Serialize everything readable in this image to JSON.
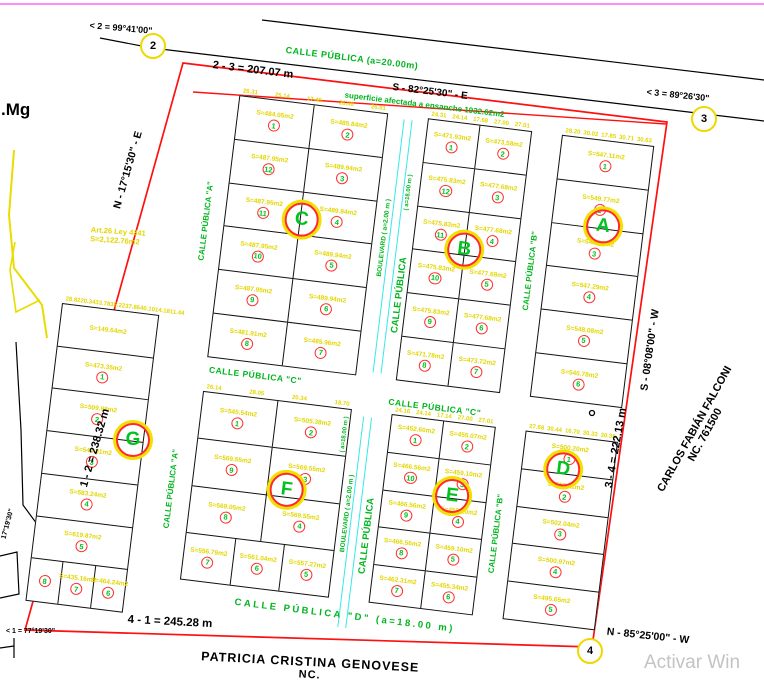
{
  "watermark": "Activar Win",
  "labels": {
    "mg": ".Mg",
    "ensanche": "superficie afectada a ensanche 1932.62m2",
    "art_law_1": "Art.26 Ley 4341",
    "art_law_2": "S=2,122.76m2",
    "left_angle_small": "17°19'30\"",
    "corner1_angle": "< 1 = 77°19'30\"",
    "corner2_angle": "< 2 = 99°41'00\"",
    "corner3_angle": "< 3 = 89°26'30\""
  },
  "boundary": {
    "top_length": "2 - 3 = 207.07 m",
    "top_bearing": "S - 82°25'30\" - E",
    "right_length": "3 - 4 = 222.13 m",
    "right_bearing": "S - 08°08'00\" - W",
    "bottom_length": "4 - 1 = 245.28 m",
    "bottom_bearing": "N - 85°25'00\" - W",
    "left_length": "1 - 2 = 238.32 m",
    "left_bearing": "N - 17°15'30\" - E",
    "corners": {
      "c1": "1",
      "c2": "2",
      "c3": "3",
      "c4": "4"
    }
  },
  "neighbors": {
    "right_name": "CARLOS FABIÁN FALCONI",
    "right_nc": "NC. 761500",
    "bottom_name": "PATRICIA CRISTINA GENOVESE",
    "bottom_nc": "NC."
  },
  "streets": {
    "top": "CALLE PÚBLICA (a=20.00m)",
    "a_upper": "CALLE PÚBLICA \"A\"",
    "a_lower": "CALLE PÚBLICA \"A\"",
    "b_upper": "CALLE PÚBLICA \"B\"",
    "b_lower": "CALLE PÚBLICA \"B\"",
    "c_left": "CALLE PÚBLICA \"C\"",
    "c_right": "CALLE PÚBLICA \"C\"",
    "d": "CALLE PÚBLICA \"D\" (a=18.00 m)",
    "central_upper": "CALLE PÚBLICA",
    "central_lower": "CALLE PÚBLICA",
    "central_width_upper": "( a=18.00 m )",
    "central_width_lower": "( a=18.00 m )",
    "boulevard_upper": "BOULEVARD ( a=2.00 m )",
    "boulevard_lower": "BOULEVARD ( a=2.00 m )"
  },
  "blocks": {
    "C": {
      "letter": "C",
      "dims": [
        "26.31",
        "25.14",
        "17.48",
        "26.00",
        "26.01"
      ],
      "lots": [
        {
          "n": "1",
          "area": "S=484.05m2"
        },
        {
          "n": "2",
          "area": "S=485.84m2"
        },
        {
          "n": "12",
          "area": "S=487.95m2"
        },
        {
          "n": "3",
          "area": "S=489.94m2"
        },
        {
          "n": "11",
          "area": "S=487.95m2"
        },
        {
          "n": "4",
          "area": "S=489.94m2"
        },
        {
          "n": "10",
          "area": "S=487.95m2"
        },
        {
          "n": "5",
          "area": "S=489.94m2"
        },
        {
          "n": "9",
          "area": "S=487.95m2"
        },
        {
          "n": "6",
          "area": "S=489.94m2"
        },
        {
          "n": "8",
          "area": "S=481.91m2"
        },
        {
          "n": "7",
          "area": "S=485.96m2"
        }
      ]
    },
    "B": {
      "letter": "B",
      "dims": [
        "24.31",
        "24.14",
        "17.68",
        "27.00",
        "27.01"
      ],
      "lots": [
        {
          "n": "1",
          "area": "S=471.93m2"
        },
        {
          "n": "2",
          "area": "S=473.58m2"
        },
        {
          "n": "12",
          "area": "S=475.83m2"
        },
        {
          "n": "3",
          "area": "S=477.68m2"
        },
        {
          "n": "11",
          "area": "S=475.83m2"
        },
        {
          "n": "4",
          "area": "S=477.68m2"
        },
        {
          "n": "10",
          "area": "S=475.83m2"
        },
        {
          "n": "5",
          "area": "S=477.68m2"
        },
        {
          "n": "9",
          "area": "S=475.83m2"
        },
        {
          "n": "6",
          "area": "S=477.68m2"
        },
        {
          "n": "8",
          "area": "S=471.78m2"
        },
        {
          "n": "7",
          "area": "S=473.72m2"
        }
      ]
    },
    "A": {
      "letter": "A",
      "dims": [
        "28.20",
        "30.02",
        "17.85",
        "30.71",
        "30.63"
      ],
      "lots": [
        {
          "n": "1",
          "area": "S=547.11m2"
        },
        {
          "n": "2",
          "area": "S=549.77m2"
        },
        {
          "n": "3",
          "area": "S=548.53m2"
        },
        {
          "n": "4",
          "area": "S=547.29m2"
        },
        {
          "n": "5",
          "area": "S=548.08m2"
        },
        {
          "n": "6",
          "area": "S=540.78m2"
        }
      ]
    },
    "F": {
      "letter": "F",
      "dims": [
        "26.14",
        "28.05",
        "20.34",
        "18.70"
      ],
      "lots": [
        {
          "n": "1",
          "area": "S=545.54m2"
        },
        {
          "n": "2",
          "area": "S=505.38m2"
        },
        {
          "n": "9",
          "area": "S=569.55m2"
        },
        {
          "n": "3",
          "area": "S=569.55m2"
        },
        {
          "n": "8",
          "area": "S=569.05m2"
        },
        {
          "n": "4",
          "area": "S=569.55m2"
        },
        {
          "n": "7",
          "area": "S=556.79m2"
        },
        {
          "n": "6",
          "area": "S=561.04m2"
        },
        {
          "n": "5",
          "area": "S=557.27m2"
        }
      ]
    },
    "E": {
      "letter": "E",
      "dims": [
        "24.16",
        "24.14",
        "17.14",
        "27.00",
        "27.01"
      ],
      "lots": [
        {
          "n": "1",
          "area": "S=452.60m2"
        },
        {
          "n": "2",
          "area": "S=455.07m2"
        },
        {
          "n": "10",
          "area": "S=466.56m2"
        },
        {
          "n": "3",
          "area": "S=459.10m2"
        },
        {
          "n": "9",
          "area": "S=466.56m2"
        },
        {
          "n": "4",
          "area": "S=459.10m2"
        },
        {
          "n": "8",
          "area": "S=466.56m2"
        },
        {
          "n": "5",
          "area": "S=459.10m2"
        },
        {
          "n": "7",
          "area": "S=462.31m2"
        },
        {
          "n": "6",
          "area": "S=455.34m2"
        }
      ]
    },
    "D": {
      "letter": "D",
      "dims": [
        "27.68",
        "30.44",
        "16.70",
        "30.33",
        "30.35"
      ],
      "lots": [
        {
          "n": "1",
          "area": "S=500.20m2"
        },
        {
          "n": "2",
          "area": "S=503.11m2"
        },
        {
          "n": "3",
          "area": "S=502.04m2"
        },
        {
          "n": "4",
          "area": "S=500.97m2"
        },
        {
          "n": "5",
          "area": "S=495.65m2"
        }
      ]
    },
    "G": {
      "letter": "G",
      "dims": [
        "28.82",
        "20.34",
        "33.78",
        "35.22",
        "37.86",
        "40.10",
        "14.18",
        "11.44"
      ],
      "lots": [
        {
          "n": "",
          "area": "S=149.64m2"
        },
        {
          "n": "1",
          "area": "S=473.35m2"
        },
        {
          "n": "2",
          "area": "S=509.98m2"
        },
        {
          "n": "3",
          "area": "S=546.81m2"
        },
        {
          "n": "4",
          "area": "S=583.24m2"
        },
        {
          "n": "5",
          "area": "S=619.87m2"
        },
        {
          "n": "8",
          "area": ""
        },
        {
          "n": "7",
          "area": "S=435.16m2"
        },
        {
          "n": "6",
          "area": "S=464.24m2"
        }
      ]
    }
  }
}
